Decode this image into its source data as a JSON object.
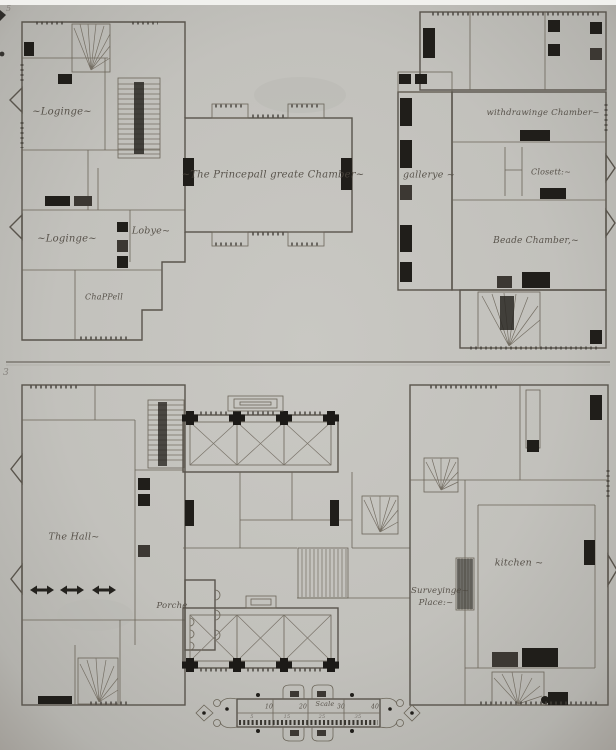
{
  "upper_plan": {
    "labels": {
      "loginge_upper": "~Loginge~",
      "loginge_lower": "~Loginge~",
      "lobye": "Lobye~",
      "chappell": "ChaPPell",
      "great_chamber": "~The Princepall greate Chamber~",
      "gallerye": "gallerye ~",
      "withdrawinge_chamber": "withdrawinge Chamber~",
      "closett": "Closett:~",
      "beade_chamber": "Beade Chamber,~"
    }
  },
  "lower_plan": {
    "labels": {
      "the_hall": "The Hall~",
      "porche": "Porche",
      "surveyinge_line1": "Surveyinge~",
      "surveyinge_line2": "Place:~",
      "kitchen": "kitchen ~"
    }
  },
  "scale_bar": {
    "title": "Scale",
    "major_labels": [
      "10",
      "20",
      "30",
      "40"
    ],
    "minor_labels": [
      "5",
      "15",
      "25",
      "35"
    ]
  },
  "margin_marks": {
    "top_left": "5",
    "left_center": "3"
  },
  "colors": {
    "paper": "#c2c1bc",
    "ink": "#59544c",
    "fill_dark": "#201e1a"
  }
}
